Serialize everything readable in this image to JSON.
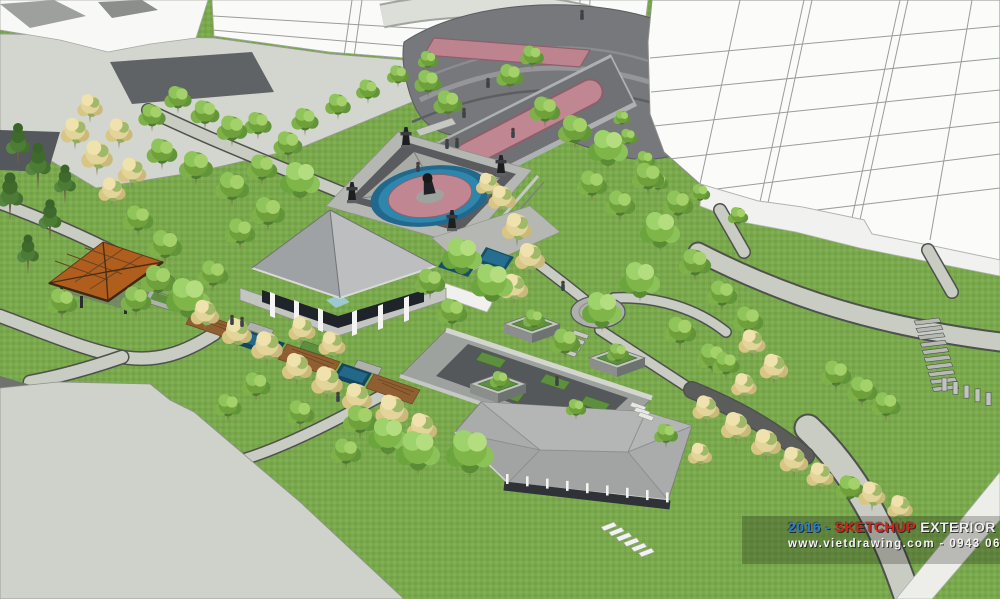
{
  "watermark": {
    "year_dash": "2016 -",
    "brand": "SKETCHUP",
    "rest": "EXTERIOR VOL.16",
    "website_line": "www.vietdrawing.com - 0943 06 06 08",
    "colors": {
      "year": "#2D7FD3",
      "brand": "#DD1F1A",
      "rest": "#EFEFED",
      "website": "#F4F4F2",
      "band": "rgba(0,0,0,0.22)"
    }
  },
  "palette": {
    "grass": "#79A74C",
    "grass_dark": "#70A043",
    "path": "#C9CCC2",
    "path_edge": "#4E524C",
    "plaza_light": "#D3D5CF",
    "plaza_dark_band": "#595B5E",
    "paving_pink": "#C08793",
    "paving_pink_edge": "#8C5F6B",
    "water_dark": "#174F66",
    "water_light": "#2E7FA6",
    "building_white": "#FBFCFA",
    "building_line": "#8E908D",
    "roof_gray": "#ACAEAD",
    "roof_orange": "#AF5E1E",
    "deck_brown": "#8F5E31",
    "tree_green": "#7FB549",
    "tree_cream": "#E3D49A",
    "tree_dark": "#4C7C35"
  },
  "scene": {
    "label": "Aerial SketchUp exterior render: landscaped park plaza with fountain, pavilion, gazebo and white apartment towers",
    "trees": [
      [
        18,
        168,
        1.0,
        "d"
      ],
      [
        38,
        190,
        1.05,
        "d"
      ],
      [
        10,
        222,
        1.1,
        "d"
      ],
      [
        50,
        242,
        0.95,
        "d"
      ],
      [
        28,
        275,
        0.9,
        "d"
      ],
      [
        65,
        205,
        0.9,
        "d"
      ],
      [
        75,
        150,
        0.95,
        "y"
      ],
      [
        97,
        176,
        1.05,
        "y"
      ],
      [
        119,
        149,
        0.9,
        "y"
      ],
      [
        90,
        123,
        0.85,
        "y"
      ],
      [
        132,
        190,
        0.95,
        "y"
      ],
      [
        112,
        208,
        0.9,
        "y"
      ],
      [
        152,
        132,
        0.8,
        "g"
      ],
      [
        178,
        114,
        0.8,
        "g"
      ],
      [
        205,
        130,
        0.85,
        "g"
      ],
      [
        232,
        147,
        0.9,
        "g"
      ],
      [
        162,
        170,
        0.9,
        "g"
      ],
      [
        196,
        186,
        1.0,
        "g"
      ],
      [
        232,
        207,
        1.0,
        "g"
      ],
      [
        262,
        186,
        0.9,
        "g"
      ],
      [
        288,
        161,
        0.85,
        "g"
      ],
      [
        258,
        140,
        0.8,
        "g"
      ],
      [
        305,
        136,
        0.8,
        "g"
      ],
      [
        338,
        120,
        0.75,
        "g"
      ],
      [
        368,
        104,
        0.7,
        "g"
      ],
      [
        398,
        88,
        0.65,
        "g"
      ],
      [
        428,
        72,
        0.6,
        "g"
      ],
      [
        300,
        202,
        1.0,
        "b"
      ],
      [
        268,
        232,
        1.0,
        "g"
      ],
      [
        138,
        237,
        0.9,
        "g"
      ],
      [
        165,
        265,
        1.0,
        "g"
      ],
      [
        240,
        250,
        0.9,
        "g"
      ],
      [
        158,
        300,
        1.0,
        "g"
      ],
      [
        188,
        322,
        1.1,
        "b"
      ],
      [
        62,
        320,
        0.9,
        "g"
      ],
      [
        213,
        292,
        0.9,
        "g"
      ],
      [
        136,
        318,
        0.9,
        "g"
      ],
      [
        205,
        332,
        0.95,
        "y"
      ],
      [
        237,
        352,
        1.0,
        "y"
      ],
      [
        267,
        367,
        1.05,
        "y"
      ],
      [
        297,
        387,
        1.0,
        "y"
      ],
      [
        327,
        402,
        1.05,
        "y"
      ],
      [
        357,
        417,
        1.0,
        "y"
      ],
      [
        392,
        432,
        1.1,
        "y"
      ],
      [
        302,
        347,
        0.9,
        "y"
      ],
      [
        332,
        362,
        0.9,
        "y"
      ],
      [
        422,
        447,
        1.0,
        "y"
      ],
      [
        256,
        402,
        0.85,
        "g"
      ],
      [
        228,
        422,
        0.8,
        "g"
      ],
      [
        360,
        440,
        1.0,
        "g"
      ],
      [
        388,
        458,
        1.0,
        "b"
      ],
      [
        418,
        475,
        1.1,
        "b"
      ],
      [
        346,
        470,
        0.9,
        "g"
      ],
      [
        300,
        430,
        0.85,
        "g"
      ],
      [
        502,
        216,
        0.9,
        "y"
      ],
      [
        517,
        247,
        1.0,
        "y"
      ],
      [
        530,
        277,
        1.0,
        "y"
      ],
      [
        514,
        306,
        0.95,
        "y"
      ],
      [
        488,
        200,
        0.8,
        "y"
      ],
      [
        462,
        278,
        1.0,
        "b"
      ],
      [
        492,
        306,
        1.05,
        "b"
      ],
      [
        452,
        330,
        0.9,
        "g"
      ],
      [
        430,
        300,
        0.9,
        "g"
      ],
      [
        448,
        120,
        0.85,
        "g"
      ],
      [
        428,
        98,
        0.8,
        "g"
      ],
      [
        545,
        128,
        0.9,
        "g"
      ],
      [
        575,
        150,
        1.0,
        "g"
      ],
      [
        608,
        170,
        1.0,
        "b"
      ],
      [
        648,
        196,
        0.95,
        "g"
      ],
      [
        678,
        222,
        0.9,
        "g"
      ],
      [
        620,
        222,
        0.9,
        "g"
      ],
      [
        592,
        202,
        0.9,
        "g"
      ],
      [
        510,
        92,
        0.8,
        "g"
      ],
      [
        532,
        70,
        0.7,
        "g"
      ],
      [
        660,
        252,
        1.0,
        "b"
      ],
      [
        695,
        282,
        0.95,
        "g"
      ],
      [
        722,
        312,
        0.9,
        "g"
      ],
      [
        748,
        338,
        0.9,
        "g"
      ],
      [
        640,
        302,
        1.0,
        "b"
      ],
      [
        602,
        332,
        1.0,
        "b"
      ],
      [
        565,
        360,
        0.9,
        "g"
      ],
      [
        680,
        350,
        0.95,
        "g"
      ],
      [
        712,
        375,
        0.9,
        "g"
      ],
      [
        628,
        148,
        0.55,
        "g"
      ],
      [
        645,
        172,
        0.6,
        "g"
      ],
      [
        658,
        194,
        0.6,
        "g"
      ],
      [
        700,
        205,
        0.6,
        "g"
      ],
      [
        622,
        128,
        0.5,
        "g"
      ],
      [
        738,
        228,
        0.6,
        "g"
      ],
      [
        752,
        360,
        0.9,
        "y"
      ],
      [
        774,
        386,
        0.95,
        "y"
      ],
      [
        744,
        402,
        0.85,
        "y"
      ],
      [
        726,
        380,
        0.8,
        "g"
      ],
      [
        836,
        392,
        0.9,
        "g"
      ],
      [
        862,
        408,
        0.9,
        "g"
      ],
      [
        886,
        422,
        0.85,
        "g"
      ],
      [
        706,
        426,
        0.9,
        "y"
      ],
      [
        736,
        446,
        1.0,
        "y"
      ],
      [
        766,
        463,
        1.0,
        "y"
      ],
      [
        794,
        479,
        0.95,
        "y"
      ],
      [
        820,
        493,
        0.9,
        "y"
      ],
      [
        850,
        505,
        0.85,
        "g"
      ],
      [
        872,
        512,
        0.9,
        "y"
      ],
      [
        900,
        524,
        0.85,
        "y"
      ],
      [
        534,
        332,
        0.65,
        "g"
      ],
      [
        618,
        366,
        0.65,
        "g"
      ],
      [
        500,
        392,
        0.6,
        "g"
      ],
      [
        576,
        420,
        0.6,
        "g"
      ],
      [
        700,
        470,
        0.8,
        "y"
      ],
      [
        666,
        448,
        0.7,
        "g"
      ],
      [
        470,
        478,
        1.2,
        "b"
      ]
    ],
    "people": [
      [
        488,
        88
      ],
      [
        464,
        118
      ],
      [
        513,
        138
      ],
      [
        447,
        149
      ],
      [
        457,
        148
      ],
      [
        418,
        172
      ],
      [
        563,
        291
      ],
      [
        232,
        325
      ],
      [
        242,
        327
      ],
      [
        557,
        386
      ],
      [
        338,
        402
      ],
      [
        582,
        20
      ]
    ],
    "urns": [
      [
        406,
        148
      ],
      [
        501,
        176
      ],
      [
        452,
        231
      ],
      [
        352,
        203
      ]
    ],
    "planters": [
      [
        532,
        330
      ],
      [
        617,
        364
      ],
      [
        498,
        390
      ]
    ],
    "stripes": [
      {
        "name": "crosswalk",
        "x": 601,
        "y": 527,
        "count": 6,
        "dx": 7.5,
        "dy": 5.2,
        "points": "0,0 13,-5 16,-1 3,4",
        "fill": "#F2F3EF",
        "stroke": "#9A9D98"
      },
      {
        "name": "right-stairs",
        "x": 914,
        "y": 321,
        "count": 10,
        "dx": 2.0,
        "dy": 7.4,
        "points": "0,0 25,-3 27,1 2,4",
        "fill": "#B7BAB4",
        "stroke": "#4E524E"
      },
      {
        "name": "medallion-stairs",
        "x": 574,
        "y": 330,
        "count": 4,
        "dx": -4,
        "dy": 6,
        "points": "0,0 15,5 13,9 -2,4",
        "fill": "#C6C9C3",
        "stroke": "#6E716C"
      },
      {
        "name": "courtyard-stairs",
        "x": 632,
        "y": 402,
        "count": 3,
        "dx": 4,
        "dy": 5,
        "points": "0,0 14,5 12,9 -2,4",
        "fill": "#E8E9E5",
        "stroke": "#9A9D98"
      },
      {
        "name": "bench-row",
        "x": 944,
        "y": 385,
        "count": 5,
        "dx": 11,
        "dy": 3.6,
        "points": "-2,-7 3,-7 3,6 -2,6",
        "fill": "#C2C5BF",
        "stroke": "#4E524E"
      },
      {
        "name": "fence-posts",
        "x": 506,
        "y": 474,
        "count": 9,
        "dx": 20,
        "dy": 2.3,
        "points": "0,0 2.6,0 2.6,10 0,10",
        "fill": "#F4F5F2",
        "stroke": "none"
      }
    ]
  }
}
